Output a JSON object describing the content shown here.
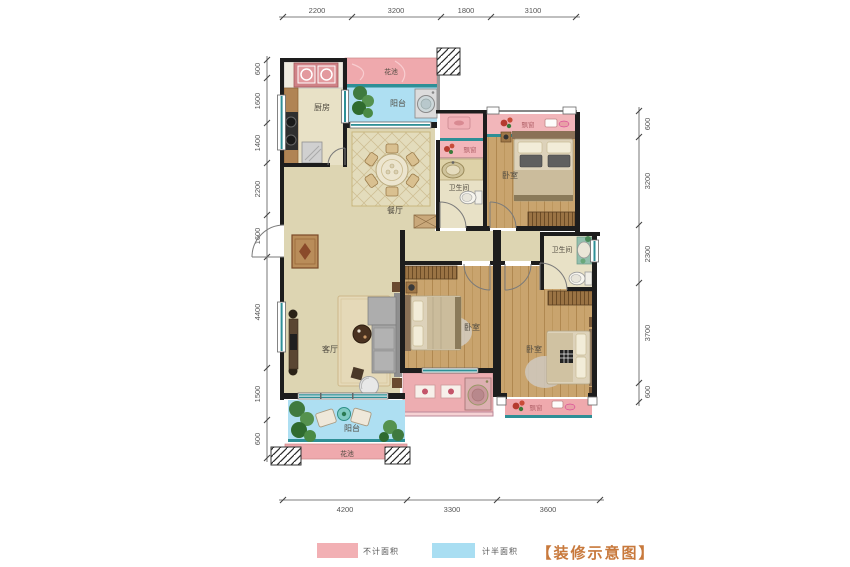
{
  "legend": {
    "items": [
      {
        "label": "不计面积",
        "swatch": "#f2b0b4"
      },
      {
        "label": "计半面积",
        "swatch": "#a9def2"
      }
    ],
    "title": "【装修示意图】"
  },
  "dimensions": {
    "top": [
      "2200",
      "3200",
      "1800",
      "3100"
    ],
    "bottom": [
      "4200",
      "3300",
      "3600"
    ],
    "left": [
      "600",
      "1600",
      "1400",
      "2200",
      "1600",
      "4400",
      "1500",
      "600"
    ],
    "right": [
      "600",
      "3200",
      "2300",
      "3700",
      "600"
    ]
  },
  "rooms": {
    "kitchen": "厨房",
    "flower_bed_top": "花池",
    "balcony_top": "阳台",
    "dining_room": "餐厅",
    "bay_window_hall": "飘窗",
    "bathroom_1": "卫生间",
    "bedroom_1": "卧室",
    "bay_window_bedroom_1": "飘窗",
    "living_room": "客厅",
    "bedroom_2": "卧室",
    "bathroom_2": "卫生间",
    "bedroom_3": "卧室",
    "bay_window_bedroom_3": "飘窗",
    "balcony_bottom": "阳台",
    "flower_bed_bottom": "花池"
  },
  "colors": {
    "uncounted_pink": "#f2b0b4",
    "half_counted_blue": "#a9def2",
    "title_orange": "#c8793c",
    "window_teal": "#2e8f96"
  }
}
